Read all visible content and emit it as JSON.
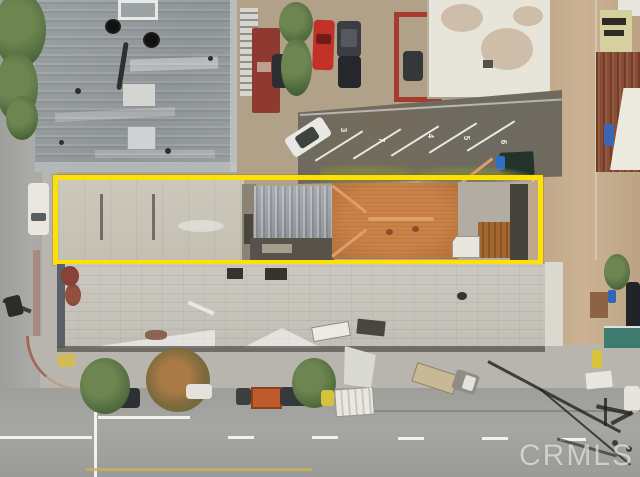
{
  "scene": {
    "type": "aerial-photograph",
    "subject": "aerial view of a commercial block with a long narrow parcel outlined in yellow",
    "watermark": "CRMLS",
    "parcel_outline_color": "#fde104",
    "parking_stalls": {
      "numbers": [
        "3",
        "7",
        "4",
        "5",
        "6"
      ]
    },
    "palette": {
      "street": "#a6a6a3",
      "parking_asphalt": "#6e6a60",
      "dirt": "#b1a189",
      "alley": "#c4ab8d",
      "metal_roof": "#959b9e",
      "tile_roof": "#c17a43",
      "flat_roof": "#c8c4b8",
      "block_roof": "#c7c4bc",
      "tree_green": "#5a7544",
      "watermark_color": "rgba(255,255,255,0.55)"
    }
  }
}
